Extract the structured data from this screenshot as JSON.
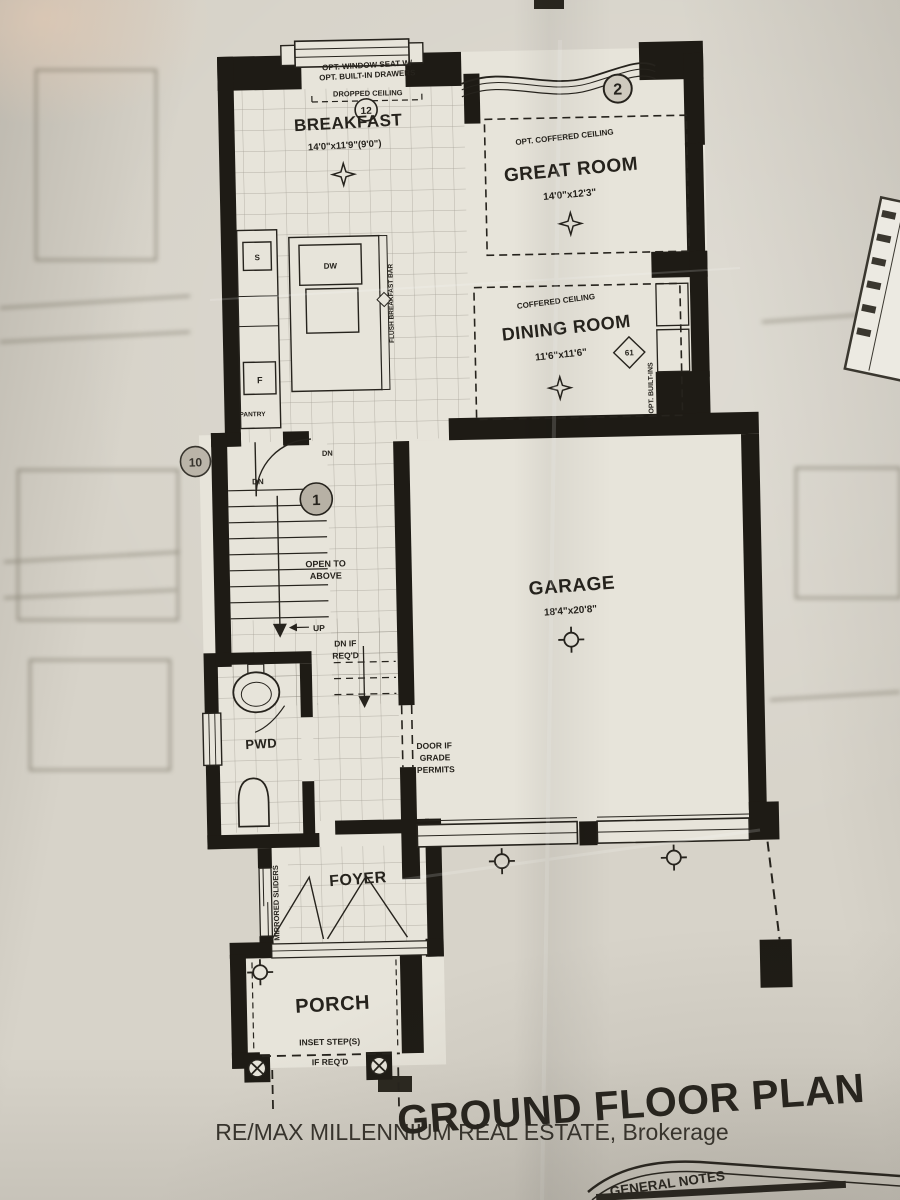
{
  "rooms": {
    "breakfast": {
      "tag": "12",
      "name": "BREAKFAST",
      "dims": "14'0\"x11'9\"(9'0\")"
    },
    "great_room": {
      "tag": "2",
      "ceiling": "OPT. COFFERED CEILING",
      "name": "GREAT ROOM",
      "dims": "14'0\"x12'3\""
    },
    "dining_room": {
      "ceiling": "COFFERED CEILING",
      "name": "DINING ROOM",
      "dims": "11'6\"x11'6\"",
      "tag": "61",
      "built_ins": "OPT. BUILT-INS"
    },
    "garage": {
      "name": "GARAGE",
      "dims": "18'4\"x20'8\""
    },
    "pwd": {
      "name": "PWD"
    },
    "foyer": {
      "name": "FOYER",
      "closet": "MIRRORED SLIDERS"
    },
    "porch": {
      "name": "PORCH"
    }
  },
  "kitchen": {
    "dw": "DW",
    "sink": "S",
    "fridge": "F",
    "pantry": "PANTRY",
    "breakfast_bar": "FLUSH BREAKFAST BAR"
  },
  "breakfast_notes": {
    "window_seat_line1": "OPT. WINDOW SEAT W/",
    "window_seat_line2": "OPT. BUILT-IN DRAWERS",
    "dropped_ceiling": "DROPPED CEILING"
  },
  "stairs": {
    "tag_left": "10",
    "tag_center": "1",
    "dn_upper": "DN",
    "dn_side": "DN",
    "open_line1": "OPEN TO",
    "open_line2": "ABOVE",
    "up": "UP",
    "dn_req_line1": "DN IF",
    "dn_req_line2": "REQ'D"
  },
  "garage_notes": {
    "door_line1": "DOOR IF",
    "door_line2": "GRADE",
    "door_line3": "PERMITS"
  },
  "porch_notes": {
    "steps_line1": "INSET STEP(S)",
    "steps_line2": "IF REQ'D"
  },
  "footer": {
    "plan_title": "GROUND FLOOR PLAN",
    "watermark": "RE/MAX MILLENNIUM REAL ESTATE, Brokerage",
    "notes_heading": "GENERAL NOTES"
  },
  "colors": {
    "paper": "#d7d3c9",
    "floor": "#e7e4da",
    "ink": "#26231d",
    "wall": "#1e1b15",
    "tag_fill": "#b7b1a5",
    "watermark": "#878682"
  }
}
